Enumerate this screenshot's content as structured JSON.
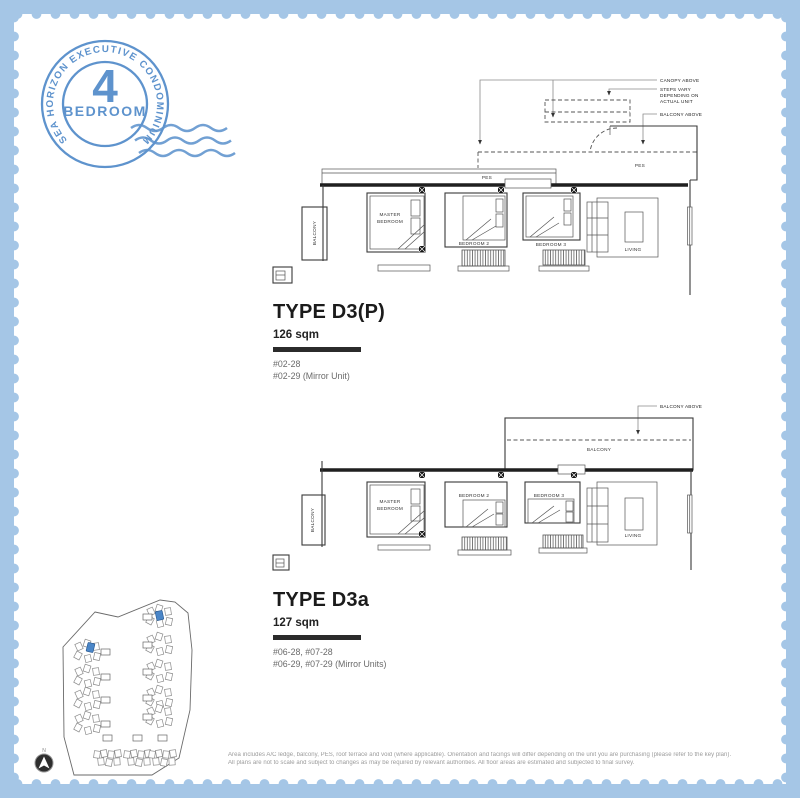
{
  "stamp": {
    "arc_text": "SEA HORIZON EXECUTIVE CONDOMINIUM",
    "number": "4",
    "label": "BEDROOM"
  },
  "plan1": {
    "title": "TYPE D3(P)",
    "area": "126 sqm",
    "units": [
      "#02-28",
      "#02-29 (Mirror Unit)"
    ],
    "annotations": {
      "canopy": "CANOPY ABOVE",
      "steps_line1": "STEPS VARY",
      "steps_line2": "DEPENDING ON",
      "steps_line3": "ACTUAL UNIT",
      "balcony_above": "BALCONY ABOVE"
    },
    "rooms": {
      "pes": "PES",
      "master_line1": "MASTER",
      "master_line2": "BEDROOM",
      "bedroom2": "BEDROOM 2",
      "bedroom3": "BEDROOM 3",
      "living": "LIVING",
      "balcony": "BALCONY"
    }
  },
  "plan2": {
    "title": "TYPE D3a",
    "area": "127 sqm",
    "units": [
      "#06-28, #07-28",
      "#06-29, #07-29 (Mirror Units)"
    ],
    "annotations": {
      "balcony_above": "BALCONY ABOVE"
    },
    "rooms": {
      "balcony_strip": "BALCONY",
      "master_line1": "MASTER",
      "master_line2": "BEDROOM",
      "bedroom2": "BEDROOM 2",
      "bedroom3": "BEDROOM 3",
      "living": "LIVING",
      "balcony": "BALCONY"
    }
  },
  "site_plan": {
    "north_label": "N"
  },
  "disclaimer": {
    "line1": "Area includes A/C ledge, balcony, PES, roof terrace and void (where applicable). Orientation and facings will differ depending on the unit you are purchasing (please refer to the key plan).",
    "line2": "All plans are not to scale and subject to changes as may be required by relevant authorities. All floor areas are estimated and subjected to final survey."
  },
  "colors": {
    "border_blue": "#a5c6e6",
    "stamp_blue": "#5e93cd",
    "site_highlight": "#4a86c8"
  }
}
